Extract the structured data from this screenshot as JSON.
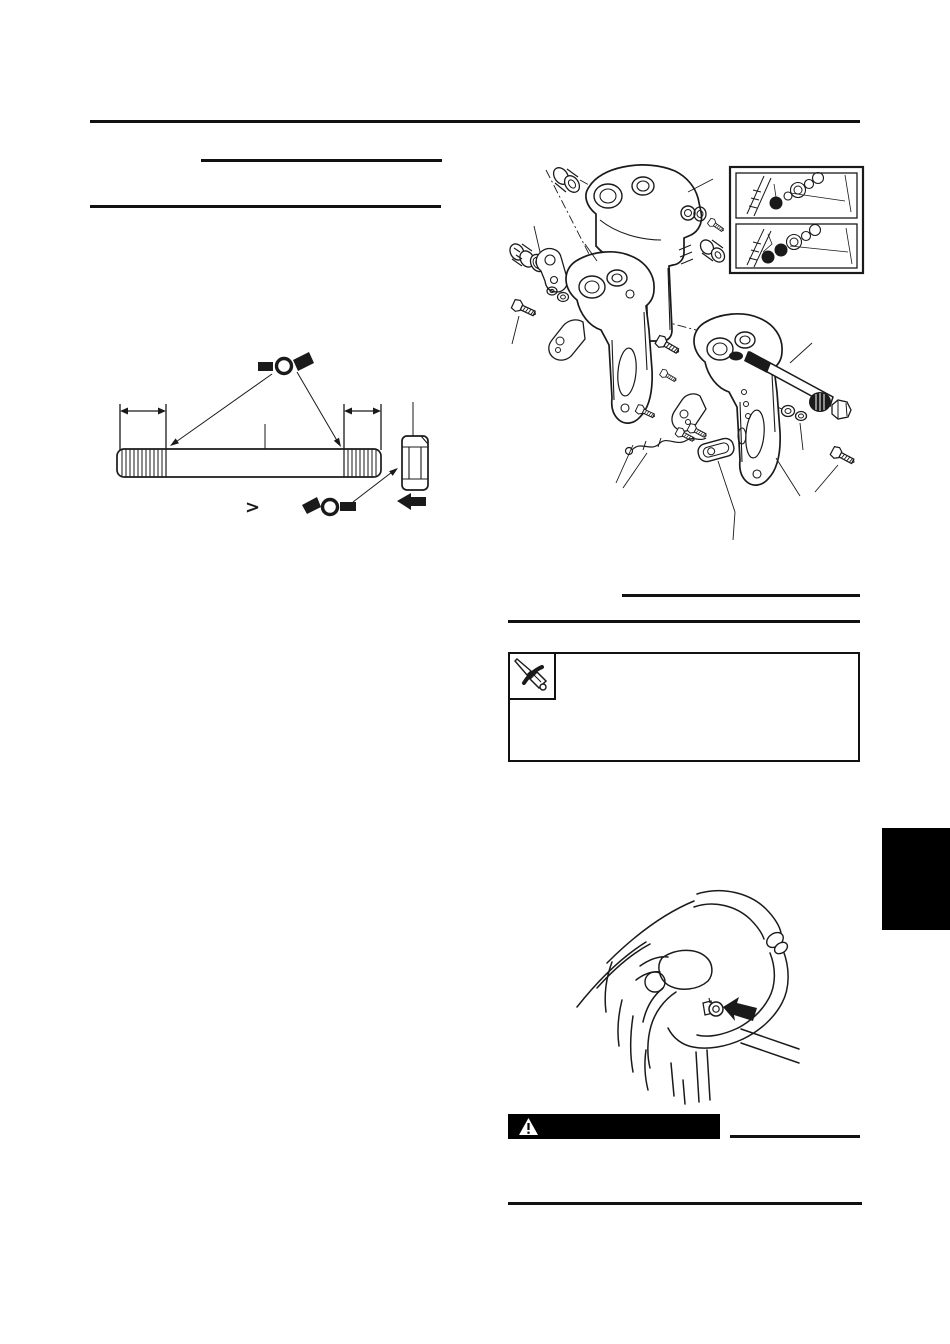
{
  "colors": {
    "paper": "#ffffff",
    "ink": "#1a1a1a",
    "banner_bg": "#000000",
    "tab_bg": "#000000"
  },
  "glyphs": {
    "comparison": ">"
  },
  "icons": {
    "grease_upper": "grease-applicator-icon",
    "grease_lower": "grease-applicator-icon",
    "note_tool": "screwdriver-icon",
    "warning": "warning-triangle-icon",
    "pointer_nut": "solid-left-arrow-icon",
    "pointer_fitting": "solid-left-arrow-icon"
  }
}
